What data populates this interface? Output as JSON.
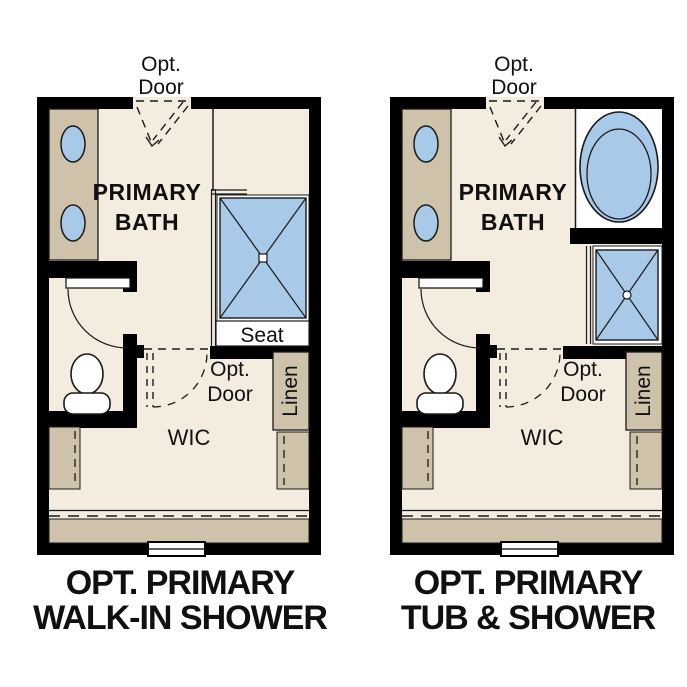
{
  "colors": {
    "wall": "#000000",
    "floor": "#f3ecdf",
    "cabinet_tan": "#cec2aa",
    "fixture_blue": "#a9c9e8",
    "fixture_white": "#ffffff",
    "text": "#101010",
    "background": "#ffffff"
  },
  "plans": [
    {
      "name": "walk-in-shower-option",
      "title": {
        "line1": "OPT. PRIMARY",
        "line2": "WALK-IN SHOWER"
      },
      "room_label": {
        "line1": "PRIMARY",
        "line2": "BATH"
      },
      "entry_door_label": {
        "line1": "Opt.",
        "line2": "Door"
      },
      "closet_door_label": {
        "line1": "Opt.",
        "line2": "Door"
      },
      "closet_label": "WIC",
      "linen_label": "Linen",
      "shower_seat_label": "Seat",
      "fixtures": [
        "double-sink-vanity",
        "walk-in-shower-with-seat",
        "toilet",
        "linen-cabinet",
        "closet-shelving",
        "window"
      ]
    },
    {
      "name": "tub-and-shower-option",
      "title": {
        "line1": "OPT. PRIMARY",
        "line2": "TUB & SHOWER"
      },
      "room_label": {
        "line1": "PRIMARY",
        "line2": "BATH"
      },
      "entry_door_label": {
        "line1": "Opt.",
        "line2": "Door"
      },
      "closet_door_label": {
        "line1": "Opt.",
        "line2": "Door"
      },
      "closet_label": "WIC",
      "linen_label": "Linen",
      "fixtures": [
        "double-sink-vanity",
        "soaking-tub",
        "shower",
        "toilet",
        "linen-cabinet",
        "closet-shelving",
        "window"
      ]
    }
  ]
}
